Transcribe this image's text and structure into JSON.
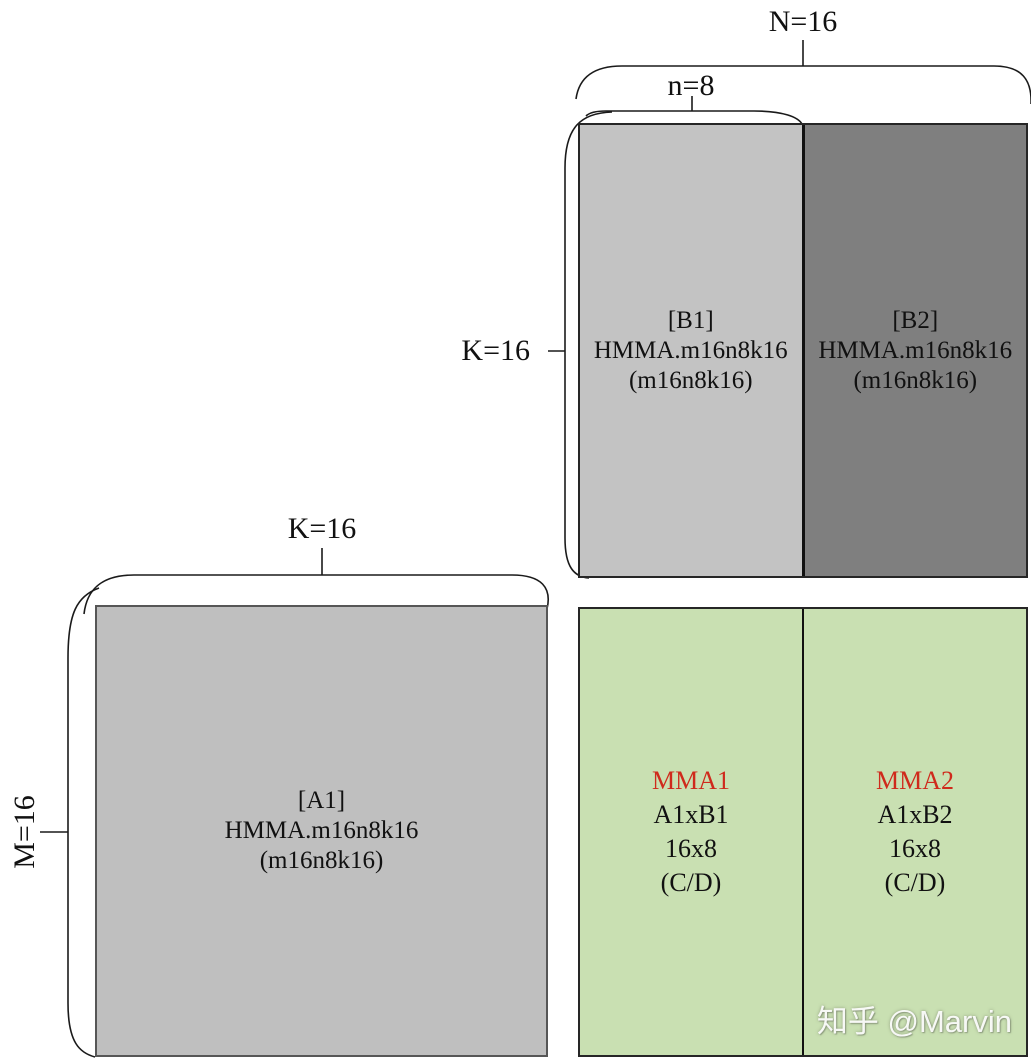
{
  "colors": {
    "b1_fill": "#c3c3c3",
    "b2_fill": "#7f7f7f",
    "a1_fill": "#bfbfbf",
    "result_fill": "#c9e0b2",
    "mma_title": "#cf2a1c",
    "line": "#1a1a1a"
  },
  "labels": {
    "n_total": "N=16",
    "n_half": "n=8",
    "k_b": "K=16",
    "k_a": "K=16",
    "m_a": "M=16"
  },
  "matrix_b1": {
    "lines": [
      "[B1]",
      "HMMA.m16n8k16",
      "(m16n8k16)"
    ]
  },
  "matrix_b2": {
    "lines": [
      "[B2]",
      "HMMA.m16n8k16",
      "(m16n8k16)"
    ]
  },
  "matrix_a1": {
    "lines": [
      "[A1]",
      "HMMA.m16n8k16",
      "(m16n8k16)"
    ]
  },
  "result_mma1": {
    "title": "MMA1",
    "lines": [
      "A1xB1",
      "16x8",
      "(C/D)"
    ]
  },
  "result_mma2": {
    "title": "MMA2",
    "lines": [
      "A1xB2",
      "16x8",
      "(C/D)"
    ]
  },
  "watermark": "知乎 @Marvin"
}
